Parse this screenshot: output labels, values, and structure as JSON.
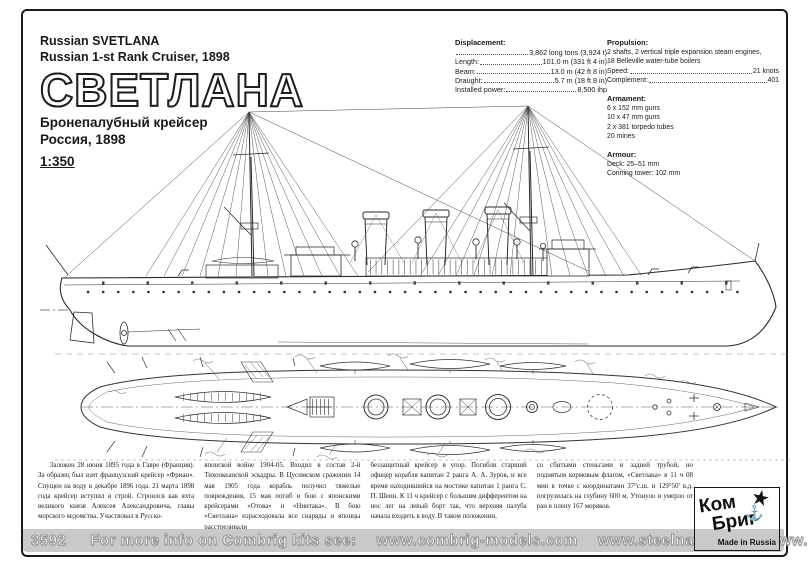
{
  "page": {
    "header": {
      "title_en_line1": "Russian SVETLANA",
      "title_en_line2": "Russian 1-st Rank Cruiser, 1898",
      "title_ru": "СВЕТЛАНА",
      "subtitle_ru_line1": "Бронепалубный крейсер",
      "subtitle_ru_line2": "Россия, 1898",
      "scale": "1:350"
    },
    "specs": {
      "displacement": {
        "heading": "Displacement:",
        "rows": [
          {
            "label": "",
            "value": "3,862 long tons (3,924 t)"
          },
          {
            "label": "Length:",
            "value": "101.0 m (331 ft 4 in)"
          },
          {
            "label": "Beam:",
            "value": "13.0 m (42 ft 8 in)"
          },
          {
            "label": "Draught:",
            "value": "5.7 m (18 ft 8 in)"
          },
          {
            "label": "Installed power:",
            "value": "8,500 ihp"
          }
        ]
      },
      "propulsion": {
        "heading": "Propulsion:",
        "line1": "2 shafts, 2 vertical triple expansion steam engines,",
        "line2": "18 Belleville water-tube boilers",
        "rows": [
          {
            "label": "Speed:",
            "value": "21 knots"
          },
          {
            "label": "Complement:",
            "value": "401"
          }
        ]
      },
      "armament": {
        "heading": "Armament:",
        "line1": "6 x 152 mm guns",
        "line2": "10 x 47 mm guns",
        "line3": "2 x 381 torpedo tubes",
        "line4": "20 mines"
      },
      "armour": {
        "heading": "Armour:",
        "line1": "Deck: 25–51 mm",
        "line2": "Conning tower: 102 mm"
      }
    },
    "history": {
      "col1": "Заложен 28 июня 1895 года в Гавре (Франция). За образец был взят французский крейсер «Фриан». Спущен на воду в декабре 1896 года. 21 марта 1898 года крейсер вступил в строй. Строился как яхта великого князя Алексея Александровича, главы морского ведомства. Участвовал в Русско-",
      "col2": "японской войне 1904-05. Входил в состав 2-й Тихоокеанской эскадры. В Цусимском сражении 14 мая 1905 года корабль получил тяжелые повреждения, 15 мая погиб в бою с японскими крейсерами «Отова» и «Ниитака». В бою «Светлана» израсходовала все снаряды и японцы расстреливали",
      "col3": "беззащитный крейсер в упор. Погибли старший офицер корабля капитан 2 ранга А. А. Зуров, и все время находившийся на мостике капитан 1 ранга С. П. Шеин. К 11 ч крейсер с большим дифферентом на нос лег на левый борт так, что верхняя палуба начала входить в воду. В таком положении,",
      "col4": "со сбитыми стеньгами и задней трубой, но поднятым кормовым флагом, «Светлана» в 11 ч 08 мин в точке с координатами 37°с.ш. и 129°50' в.д. погрузилась на глубину 600 м. Утонуло и умерло от ран в плену 167 моряков."
    },
    "footer": {
      "kit_number": "3592",
      "info_text": "For more info on Combrig kits see:",
      "links": [
        "www.combrig-models.com",
        "www.steelnavy.com",
        "www.modelwarships.com"
      ]
    },
    "logo": {
      "line1": "Ком",
      "line2": "Бриг",
      "made_in": "Made in Russia",
      "star_glyph": "★",
      "anchor_glyph": "⚓"
    },
    "colors": {
      "ink": "#1a1a1a",
      "footer_bar": "#c9c9c9",
      "paper": "#ffffff"
    }
  }
}
